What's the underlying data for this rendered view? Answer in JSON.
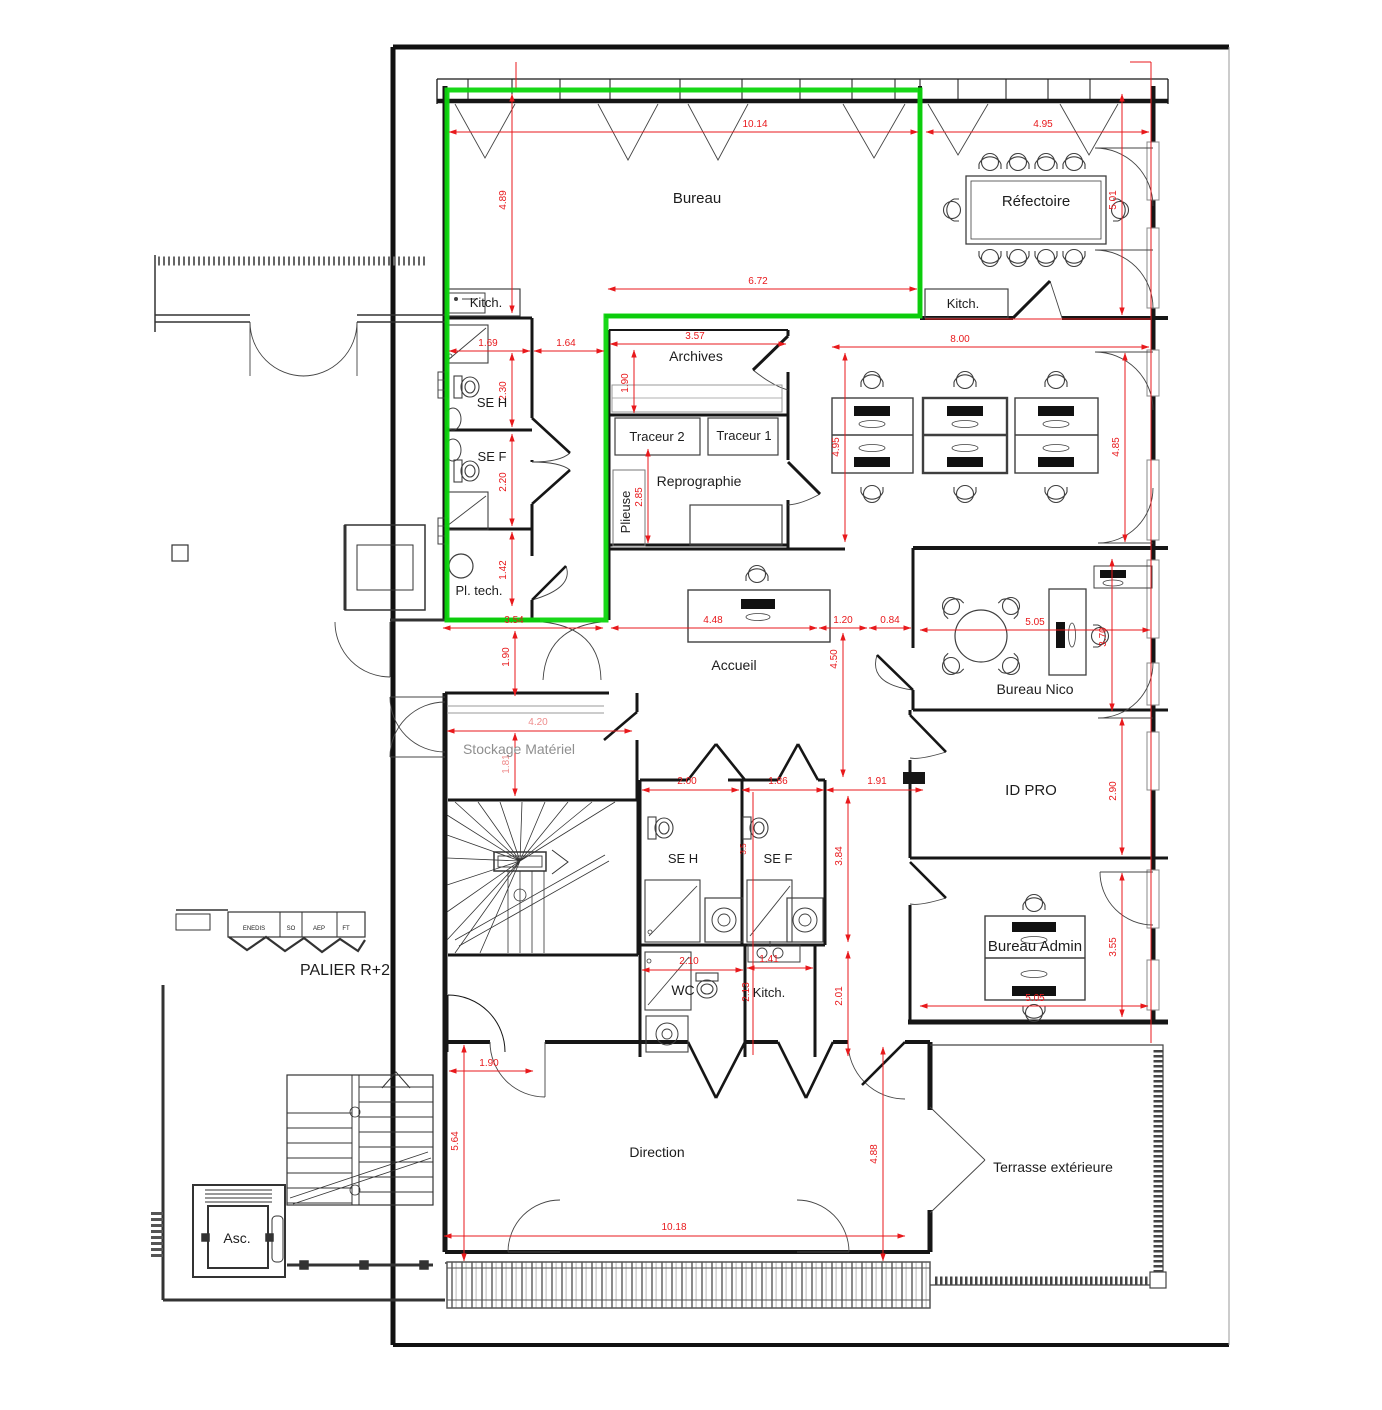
{
  "title": "Plan d'étage PALIER R+2",
  "colors": {
    "wall": "#161616",
    "thin": "#444444",
    "furniture": "#3f3f3f",
    "shelf_gray": "#999999",
    "dimension_red": "#e8191c",
    "dimension_light": "#ef8d8d",
    "highlight_green": "#0cd60c",
    "gray_text": "#8f8f8f",
    "label_black": "#1d1d1d"
  },
  "labels": [
    {
      "text": "Bureau",
      "x": 697,
      "y": 203,
      "size": 15
    },
    {
      "text": "Réfectoire",
      "x": 1036,
      "y": 206,
      "size": 15
    },
    {
      "text": "Kitch.",
      "x": 486,
      "y": 307,
      "size": 13
    },
    {
      "text": "Kitch.",
      "x": 963,
      "y": 308,
      "size": 13
    },
    {
      "text": "SE H",
      "x": 492,
      "y": 407,
      "size": 13
    },
    {
      "text": "SE F",
      "x": 492,
      "y": 461,
      "size": 13
    },
    {
      "text": "Pl. tech.",
      "x": 479,
      "y": 595,
      "size": 13
    },
    {
      "text": "Archives",
      "x": 696,
      "y": 361,
      "size": 14
    },
    {
      "text": "Traceur 2",
      "x": 657,
      "y": 441,
      "size": 13
    },
    {
      "text": "Traceur 1",
      "x": 744,
      "y": 440,
      "size": 13
    },
    {
      "text": "Reprographie",
      "x": 699,
      "y": 486,
      "size": 14
    },
    {
      "text": "Plieuse",
      "x": 630,
      "y": 512,
      "size": 13,
      "rot": -90
    },
    {
      "text": "Accueil",
      "x": 734,
      "y": 670,
      "size": 14
    },
    {
      "text": "Bureau Nico",
      "x": 1035,
      "y": 694,
      "size": 14
    },
    {
      "text": "Stockage Matériel",
      "x": 519,
      "y": 754,
      "size": 14,
      "color": "#8f8f8f"
    },
    {
      "text": "ID PRO",
      "x": 1031,
      "y": 795,
      "size": 15
    },
    {
      "text": "SE H",
      "x": 683,
      "y": 863,
      "size": 13
    },
    {
      "text": "SE F",
      "x": 778,
      "y": 863,
      "size": 13
    },
    {
      "text": "WC",
      "x": 683,
      "y": 995,
      "size": 14
    },
    {
      "text": "Kitch.",
      "x": 769,
      "y": 997,
      "size": 13
    },
    {
      "text": "Bureau Admin",
      "x": 1035,
      "y": 951,
      "size": 15
    },
    {
      "text": "Direction",
      "x": 657,
      "y": 1157,
      "size": 14
    },
    {
      "text": "Terrasse extérieure",
      "x": 1053,
      "y": 1172,
      "size": 14
    },
    {
      "text": "PALIER R+2",
      "x": 345,
      "y": 975,
      "size": 16
    },
    {
      "text": "Asc.",
      "x": 237,
      "y": 1243,
      "size": 14
    },
    {
      "text": "ENEDIS",
      "x": 254,
      "y": 930,
      "size": 6
    },
    {
      "text": "SO",
      "x": 291,
      "y": 930,
      "size": 6
    },
    {
      "text": "AEP",
      "x": 319,
      "y": 930,
      "size": 6
    },
    {
      "text": "FT",
      "x": 346,
      "y": 930,
      "size": 6
    }
  ],
  "dimensions": [
    {
      "v": "10.14",
      "x1": 449,
      "y1": 132,
      "x2": 918,
      "y2": 132,
      "lx": 755,
      "ly": 127
    },
    {
      "v": "4.95",
      "x1": 926,
      "y1": 132,
      "x2": 1149,
      "y2": 132,
      "lx": 1043,
      "ly": 127
    },
    {
      "v": "4.89",
      "x1": 512,
      "y1": 94,
      "x2": 512,
      "y2": 313,
      "lx": 506,
      "ly": 200,
      "rot": -90
    },
    {
      "v": "5.01",
      "x1": 1122,
      "y1": 94,
      "x2": 1122,
      "y2": 315,
      "lx": 1116,
      "ly": 200,
      "rot": -90
    },
    {
      "v": "6.72",
      "x1": 608,
      "y1": 289,
      "x2": 917,
      "y2": 289,
      "lx": 758,
      "ly": 284
    },
    {
      "v": "1.69",
      "x1": 449,
      "y1": 351,
      "x2": 530,
      "y2": 351,
      "lx": 488,
      "ly": 346
    },
    {
      "v": "1.64",
      "x1": 534,
      "y1": 351,
      "x2": 604,
      "y2": 351,
      "lx": 566,
      "ly": 346
    },
    {
      "v": "3.57",
      "x1": 610,
      "y1": 344,
      "x2": 786,
      "y2": 344,
      "lx": 695,
      "ly": 339
    },
    {
      "v": "8.00",
      "x1": 832,
      "y1": 347,
      "x2": 1149,
      "y2": 347,
      "lx": 960,
      "ly": 342
    },
    {
      "v": "1.90",
      "x1": 634,
      "y1": 350,
      "x2": 634,
      "y2": 413,
      "lx": 628,
      "ly": 383,
      "rot": -90
    },
    {
      "v": "2.30",
      "x1": 512,
      "y1": 353,
      "x2": 512,
      "y2": 427,
      "lx": 506,
      "ly": 391,
      "rot": -90
    },
    {
      "v": "2.20",
      "x1": 512,
      "y1": 434,
      "x2": 512,
      "y2": 526,
      "lx": 506,
      "ly": 482,
      "rot": -90
    },
    {
      "v": "1.42",
      "x1": 512,
      "y1": 532,
      "x2": 512,
      "y2": 606,
      "lx": 506,
      "ly": 570,
      "rot": -90
    },
    {
      "v": "2.85",
      "x1": 648,
      "y1": 449,
      "x2": 648,
      "y2": 543,
      "lx": 642,
      "ly": 497,
      "rot": -90
    },
    {
      "v": "4.95",
      "x1": 845,
      "y1": 353,
      "x2": 845,
      "y2": 542,
      "lx": 839,
      "ly": 447,
      "rot": -90
    },
    {
      "v": "4.85",
      "x1": 1125,
      "y1": 353,
      "x2": 1125,
      "y2": 542,
      "lx": 1119,
      "ly": 447,
      "rot": -90
    },
    {
      "v": "3.54",
      "x1": 443,
      "y1": 628,
      "x2": 603,
      "y2": 628,
      "lx": 514,
      "ly": 623
    },
    {
      "v": "4.48",
      "x1": 611,
      "y1": 628,
      "x2": 817,
      "y2": 628,
      "lx": 713,
      "ly": 623
    },
    {
      "v": "1.20",
      "x1": 819,
      "y1": 628,
      "x2": 867,
      "y2": 628,
      "lx": 843,
      "ly": 623
    },
    {
      "v": "0.84",
      "x1": 869,
      "y1": 628,
      "x2": 911,
      "y2": 628,
      "lx": 890,
      "ly": 623
    },
    {
      "v": "5.05",
      "x1": 920,
      "y1": 630,
      "x2": 1150,
      "y2": 630,
      "lx": 1035,
      "ly": 625
    },
    {
      "v": "3.70",
      "x1": 1112,
      "y1": 559,
      "x2": 1112,
      "y2": 711,
      "lx": 1106,
      "ly": 637,
      "rot": -90
    },
    {
      "v": "4.50",
      "x1": 843,
      "y1": 633,
      "x2": 843,
      "y2": 777,
      "lx": 837,
      "ly": 659,
      "rot": -90
    },
    {
      "v": "1.90",
      "x1": 515,
      "y1": 631,
      "x2": 515,
      "y2": 696,
      "lx": 509,
      "ly": 657,
      "rot": -90
    },
    {
      "v": "4.20",
      "x1": 447,
      "y1": 731,
      "x2": 632,
      "y2": 731,
      "lx": 538,
      "ly": 725,
      "light": true
    },
    {
      "v": "1.81",
      "x1": 515,
      "y1": 733,
      "x2": 515,
      "y2": 796,
      "lx": 509,
      "ly": 764,
      "rot": -90,
      "light": true
    },
    {
      "v": "2.00",
      "x1": 642,
      "y1": 790,
      "x2": 739,
      "y2": 790,
      "lx": 687,
      "ly": 784
    },
    {
      "v": "1.86",
      "x1": 742,
      "y1": 790,
      "x2": 824,
      "y2": 790,
      "lx": 778,
      "ly": 784
    },
    {
      "v": "1.91",
      "x1": 826,
      "y1": 790,
      "x2": 923,
      "y2": 790,
      "lx": 877,
      "ly": 784
    },
    {
      "v": "3.84",
      "x1": 848,
      "y1": 796,
      "x2": 848,
      "y2": 942,
      "lx": 842,
      "ly": 856,
      "rot": -90
    },
    {
      "v": "3.5",
      "lx": 746,
      "ly": 849,
      "rot": -90,
      "size": 8
    },
    {
      "v": "2.90",
      "x1": 1122,
      "y1": 718,
      "x2": 1122,
      "y2": 855,
      "lx": 1116,
      "ly": 791,
      "rot": -90
    },
    {
      "v": "2.10",
      "x1": 642,
      "y1": 970,
      "x2": 743,
      "y2": 970,
      "lx": 689,
      "ly": 964
    },
    {
      "v": "1.41",
      "x1": 747,
      "y1": 968,
      "x2": 813,
      "y2": 968,
      "lx": 769,
      "ly": 962
    },
    {
      "v": "2.13",
      "lx": 749,
      "ly": 992,
      "rot": -90
    },
    {
      "v": "2.01",
      "x1": 848,
      "y1": 951,
      "x2": 848,
      "y2": 1056,
      "lx": 842,
      "ly": 996,
      "rot": -90
    },
    {
      "v": "3.55",
      "x1": 1122,
      "y1": 873,
      "x2": 1122,
      "y2": 1017,
      "lx": 1116,
      "ly": 947,
      "rot": -90
    },
    {
      "v": "5.05",
      "x1": 920,
      "y1": 1006,
      "x2": 1148,
      "y2": 1006,
      "lx": 1035,
      "ly": 1001
    },
    {
      "v": "1.90",
      "x1": 449,
      "y1": 1071,
      "x2": 533,
      "y2": 1071,
      "lx": 489,
      "ly": 1066
    },
    {
      "v": "5.64",
      "x1": 464,
      "y1": 1045,
      "x2": 464,
      "y2": 1261,
      "lx": 458,
      "ly": 1141,
      "rot": -90
    },
    {
      "v": "4.88",
      "x1": 883,
      "y1": 1047,
      "x2": 883,
      "y2": 1261,
      "lx": 877,
      "ly": 1154,
      "rot": -90
    },
    {
      "v": "10.18",
      "x1": 444,
      "y1": 1236,
      "x2": 905,
      "y2": 1236,
      "lx": 674,
      "ly": 1230
    }
  ]
}
